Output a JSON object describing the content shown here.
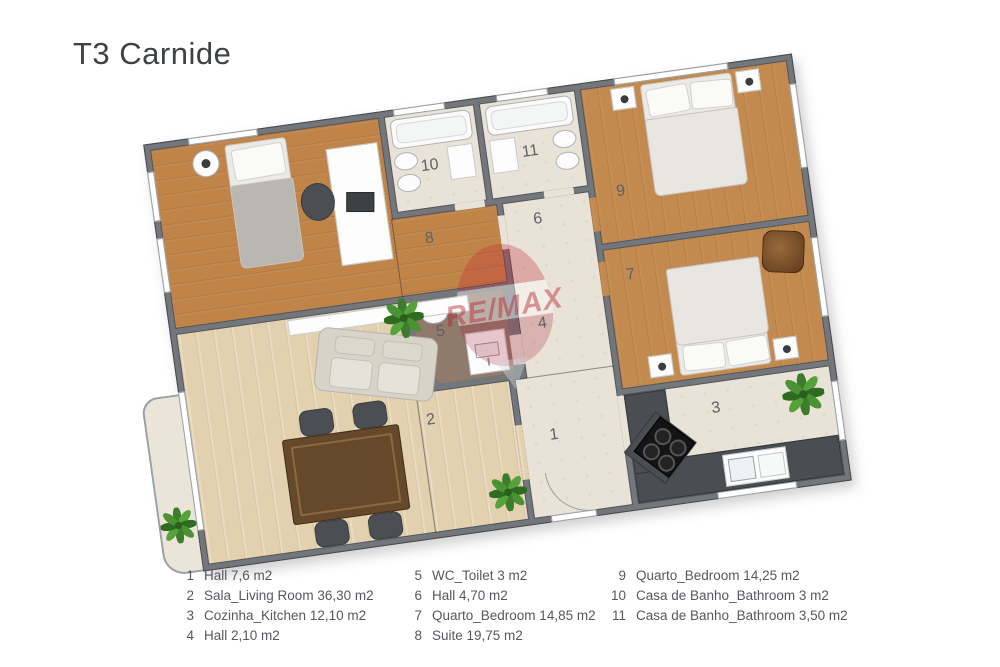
{
  "title": "T3 Carnide",
  "watermark": {
    "text": "RE/MAX"
  },
  "colors": {
    "wall": "#73777b",
    "wood_warm": "#c08449",
    "wood_light": "#e3d0ae",
    "tile": "#e8e2d7",
    "wc_floor": "#8f7a6b",
    "kitchen_counter": "#4a4e52",
    "plant_green": "#3c7c2a",
    "watermark_red": "#c22433",
    "title_text": "#3e4245",
    "legend_text": "#55585c"
  },
  "plan": {
    "labels": {
      "hall1": "1",
      "living": "2",
      "kitchen": "3",
      "hall4": "4",
      "wc": "5",
      "hall6": "6",
      "bedroom7": "7",
      "suite": "8",
      "bedroom9": "9",
      "bath10": "10",
      "bath11": "11"
    }
  },
  "legend": {
    "columns": [
      {
        "items": [
          {
            "num": "1",
            "text": "Hall 7,6 m2"
          },
          {
            "num": "2",
            "text": "Sala_Living Room 36,30 m2"
          },
          {
            "num": "3",
            "text": "Cozinha_Kitchen 12,10 m2"
          },
          {
            "num": "4",
            "text": "Hall 2,10 m2"
          }
        ]
      },
      {
        "items": [
          {
            "num": "5",
            "text": "WC_Toilet 3 m2"
          },
          {
            "num": "6",
            "text": "Hall 4,70 m2"
          },
          {
            "num": "7",
            "text": "Quarto_Bedroom 14,85 m2"
          },
          {
            "num": "8",
            "text": "Suite 19,75 m2"
          }
        ]
      },
      {
        "items": [
          {
            "num": "9",
            "text": "Quarto_Bedroom 14,25 m2"
          },
          {
            "num": "10",
            "text": "Casa de Banho_Bathroom 3 m2"
          },
          {
            "num": "11",
            "text": "Casa de Banho_Bathroom 3,50 m2"
          }
        ]
      }
    ]
  }
}
